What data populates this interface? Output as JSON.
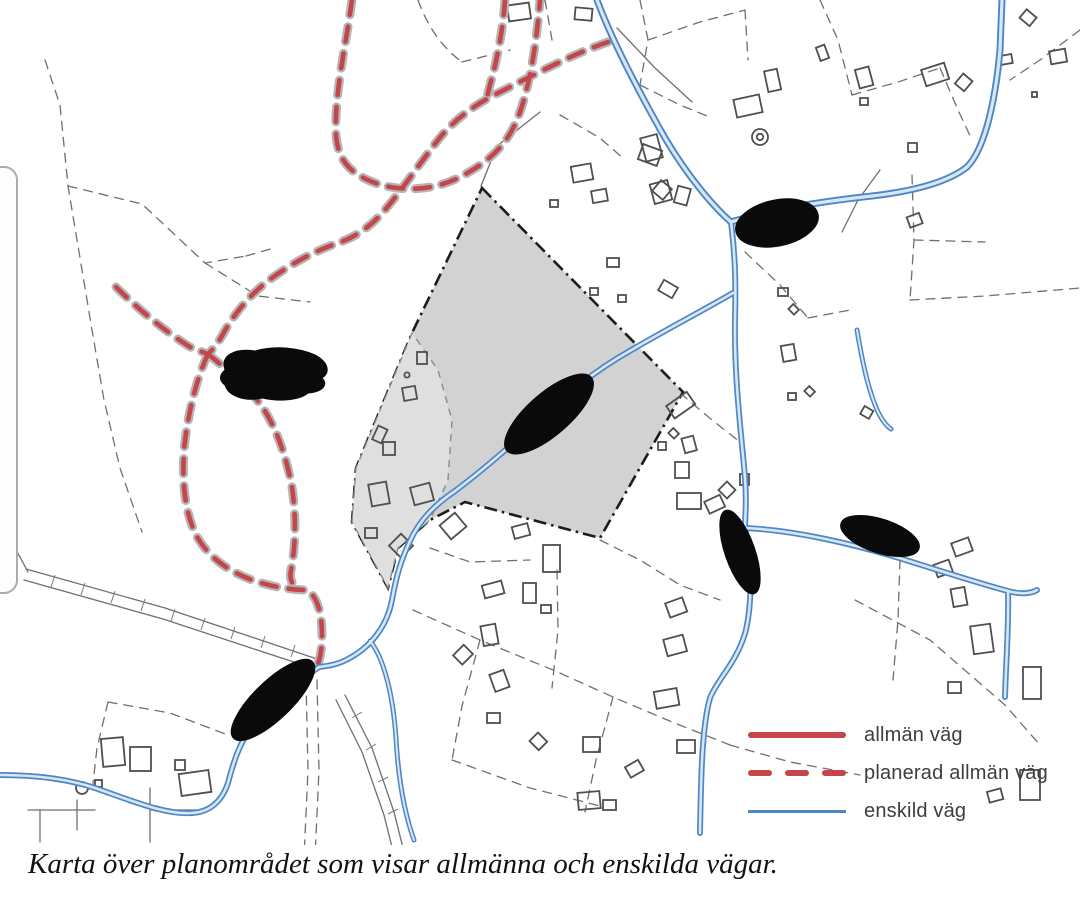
{
  "map": {
    "title": "Karta över planområdet",
    "redaction_count": 6,
    "features": {
      "plan_area": "grå markerad planområdesyta",
      "redactions": "svarta överstrykningar av ortnamn"
    }
  },
  "colors": {
    "public_road": "#c4464b",
    "planned_public_road": "#c4464b",
    "private_road": "#4d87c5",
    "parcel_line": "#6f6f6f",
    "plan_area": "#d2d2d2",
    "plan_subarea": "#dfdfdf",
    "redaction": "#0a0a0a"
  },
  "legend": {
    "items": [
      {
        "label": "allmän väg",
        "style": "solid",
        "color": "#c4464b"
      },
      {
        "label": "planerad allmän väg",
        "style": "dashed",
        "color": "#c4464b"
      },
      {
        "label": "enskild väg",
        "style": "solid",
        "color": "#4d87c5"
      }
    ]
  },
  "caption": "Karta över planområdet som visar allmänna och enskilda vägar."
}
